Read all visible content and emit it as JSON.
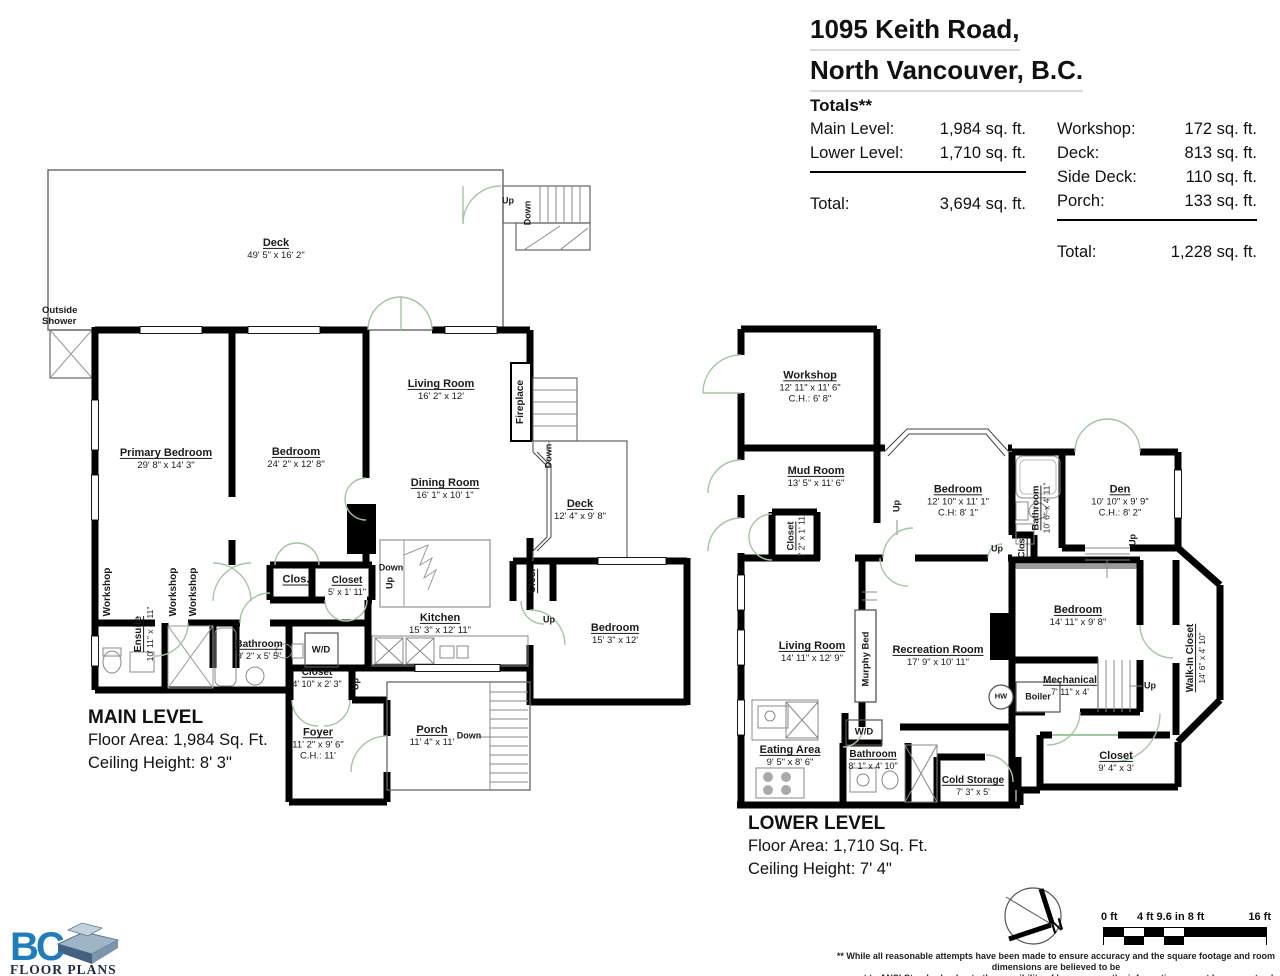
{
  "header": {
    "address_line1": "1095 Keith Road,",
    "address_line2": "North Vancouver, B.C.",
    "totals_title": "Totals**",
    "left": {
      "rows": [
        {
          "label": "Main Level:",
          "value": "1,984 sq. ft."
        },
        {
          "label": "Lower Level:",
          "value": "1,710 sq. ft."
        }
      ],
      "total_label": "Total:",
      "total_value": "3,694 sq. ft."
    },
    "right": {
      "rows": [
        {
          "label": "Workshop:",
          "value": "172 sq. ft."
        },
        {
          "label": "Deck:",
          "value": "813 sq. ft."
        },
        {
          "label": "Side Deck:",
          "value": "110 sq. ft."
        },
        {
          "label": "Porch:",
          "value": "133 sq. ft."
        }
      ],
      "total_label": "Total:",
      "total_value": "1,228 sq. ft."
    }
  },
  "main_level": {
    "title": "MAIN LEVEL",
    "floor_area": "Floor Area: 1,984 Sq. Ft.",
    "ceiling_height": "Ceiling Height: 8' 3\"",
    "rooms": {
      "deck": {
        "name": "Deck",
        "dims": "49' 5\" x 16' 2\""
      },
      "outside_shower": {
        "name": "Outside Shower"
      },
      "primary_bedroom": {
        "name": "Primary Bedroom",
        "dims": "29' 8\" x 14' 3\""
      },
      "bedroom2": {
        "name": "Bedroom",
        "dims": "24' 2\" x 12' 8\""
      },
      "living_room": {
        "name": "Living Room",
        "dims": "16' 2\" x 12'"
      },
      "dining_room": {
        "name": "Dining Room",
        "dims": "16' 1\" x 10' 1\""
      },
      "kitchen": {
        "name": "Kitchen",
        "dims": "15' 3\" x 12' 11\""
      },
      "bedroom3": {
        "name": "Bedroom",
        "dims": "15' 3\" x 12'"
      },
      "deck_side": {
        "name": "Deck",
        "dims": "12' 4\" x 9' 8\""
      },
      "fireplace": {
        "name": "Fireplace"
      },
      "clos_deck": {
        "name": "Clos."
      },
      "clos_hall": {
        "name": "Clos."
      },
      "closet_hall": {
        "name": "Closet",
        "dims": "5' x 1' 11\""
      },
      "bathroom": {
        "name": "Bathroom",
        "dims": "9' 2\" x 5' 5\""
      },
      "wd": {
        "name": "W/D"
      },
      "ensuite": {
        "name": "Ensuite",
        "dims": "10' 11\" x 5' 11\""
      },
      "workshop": {
        "name": "Workshop"
      },
      "closet_foyer": {
        "name": "Closet",
        "dims": "4' 10\" x 2' 3\""
      },
      "foyer": {
        "name": "Foyer",
        "dims": "11' 2\" x 9' 6\"",
        "ch": "C.H.: 11'"
      },
      "porch": {
        "name": "Porch",
        "dims": "11' 4\" x 11'"
      }
    }
  },
  "lower_level": {
    "title": "LOWER LEVEL",
    "floor_area": "Floor Area: 1,710 Sq. Ft.",
    "ceiling_height": "Ceiling Height: 7' 4\"",
    "rooms": {
      "workshop": {
        "name": "Workshop",
        "dims": "12' 11\" x 11' 6\"",
        "ch": "C.H.: 6' 8\""
      },
      "mud_room": {
        "name": "Mud Room",
        "dims": "13' 5\" x 11' 6\""
      },
      "closet_mud": {
        "name": "Closet",
        "dims": "5' 2\" x 1' 11\""
      },
      "bedroom1": {
        "name": "Bedroom",
        "dims": "12' 10\" x 11' 1\"",
        "ch": "C.H: 8' 1\""
      },
      "bathroom1": {
        "name": "Bathroom",
        "dims": "10' 6\" x 4' 11\""
      },
      "clos": {
        "name": "Clos."
      },
      "den": {
        "name": "Den",
        "dims": "10' 10\" x 9' 9\"",
        "ch": "C.H.: 8' 2\""
      },
      "living_room": {
        "name": "Living Room",
        "dims": "14' 11\" x 12' 9\""
      },
      "murphy_bed": {
        "name": "Murphy Bed"
      },
      "rec_room": {
        "name": "Recreation Room",
        "dims": "17' 9\" x 10' 11\""
      },
      "bedroom2": {
        "name": "Bedroom",
        "dims": "14' 11\" x 9' 8\""
      },
      "walk_in": {
        "name": "Walk-In Closet",
        "dims": "14' 6\" x 4' 10\""
      },
      "eating": {
        "name": "Eating Area",
        "dims": "9' 5\" x 8' 6\""
      },
      "wd": {
        "name": "W/D"
      },
      "bathroom2": {
        "name": "Bathroom",
        "dims": "8' 1\" x 4' 10\""
      },
      "cold_storage": {
        "name": "Cold Storage",
        "dims": "7' 3\" x 5'"
      },
      "mechanical": {
        "name": "Mechanical",
        "dims": "7' 11\" x 4'"
      },
      "boiler": {
        "name": "Boiler"
      },
      "hw": {
        "name": "HW"
      },
      "closet_br": {
        "name": "Closet",
        "dims": "9' 4\" x 3'"
      }
    }
  },
  "misc": {
    "up": "Up",
    "down": "Down"
  },
  "compass": {
    "north": "N"
  },
  "scale_bar": {
    "zero": "0 ft",
    "mid": "4 ft 9.6 in 8 ft",
    "end": "16 ft"
  },
  "logo": {
    "bc": "BC",
    "floor_plans": "FLOOR PLANS"
  },
  "disclaimer": {
    "line1": "** While all reasonable attempts have been made to ensure accuracy and the square footage and room dimensions are believed to be",
    "line2": "correct to ANSI Standards, due to the possibility of human error the information cannot be guaranteed. E&O Insured for $1,000,000"
  }
}
